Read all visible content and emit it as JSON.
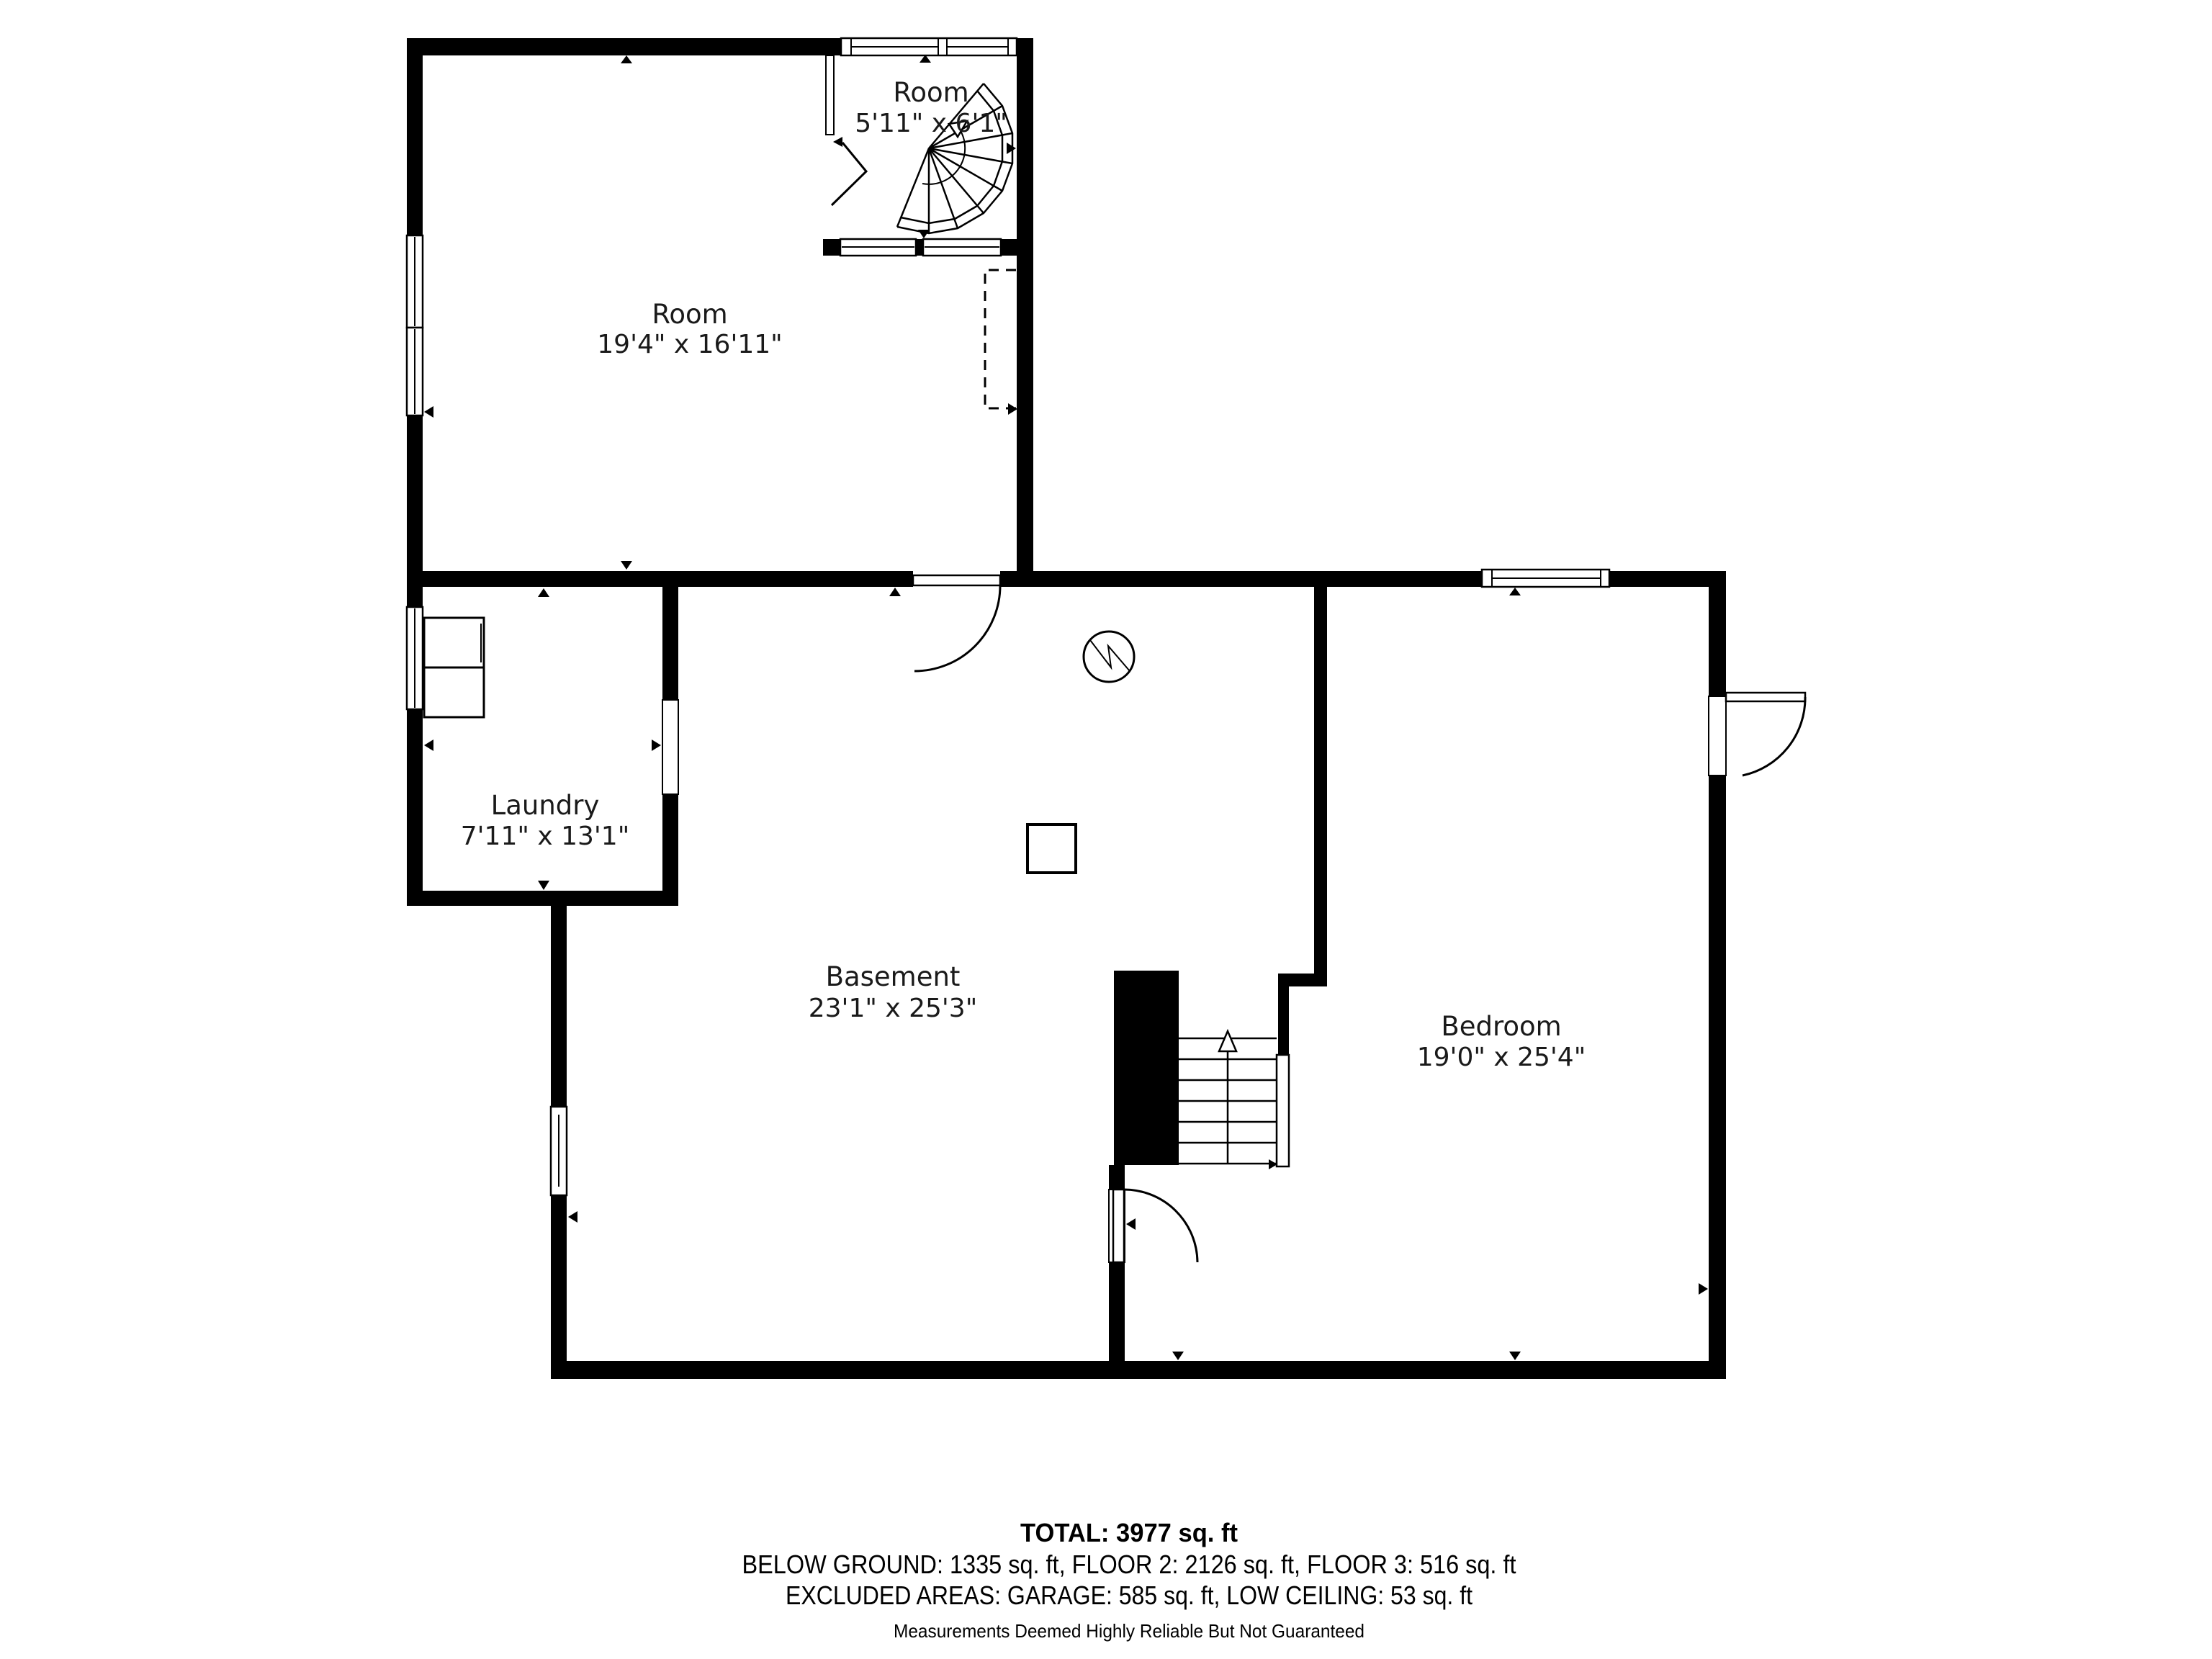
{
  "page": {
    "background": "#ffffff",
    "wall_color": "#000000"
  },
  "rooms": [
    {
      "id": "upper-room",
      "label": "Room",
      "dims": "5'11\" x 6'1\""
    },
    {
      "id": "main-room",
      "label": "Room",
      "dims": "19'4\" x 16'11\""
    },
    {
      "id": "laundry",
      "label": "Laundry",
      "dims": "7'11\" x 13'1\""
    },
    {
      "id": "basement",
      "label": "Basement",
      "dims": "23'1\" x 25'3\""
    },
    {
      "id": "bedroom",
      "label": "Bedroom",
      "dims": "19'0\" x 25'4\""
    }
  ],
  "footer": {
    "total": "TOTAL: 3977 sq. ft",
    "breakdown": "BELOW GROUND: 1335 sq. ft, FLOOR 2: 2126 sq. ft, FLOOR 3: 516 sq. ft",
    "excluded": "EXCLUDED AREAS: GARAGE: 585 sq. ft, LOW CEILING: 53 sq. ft",
    "disclaimer": "Measurements Deemed Highly Reliable But Not Guaranteed"
  }
}
